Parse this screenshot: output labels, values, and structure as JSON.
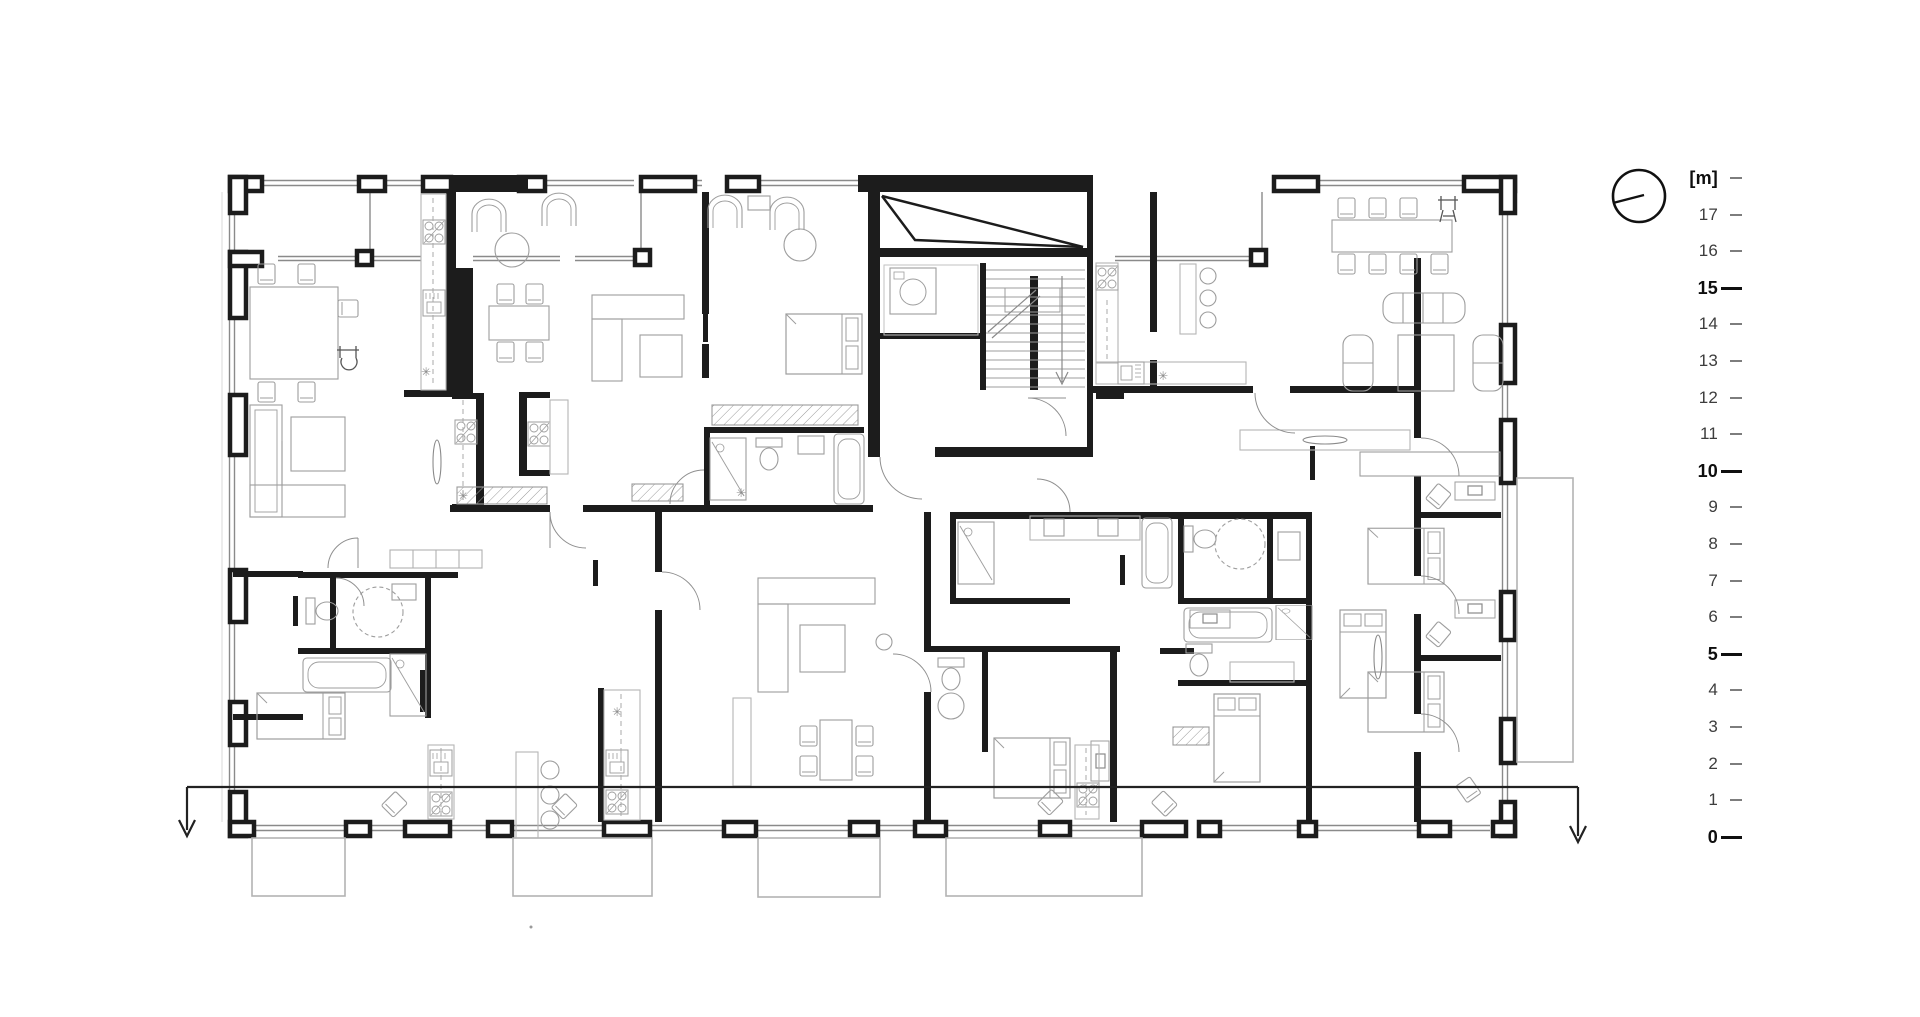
{
  "drawing": {
    "kind": "floor-plan"
  },
  "colors": {
    "background": "#ffffff",
    "wall": "#1c1c1c",
    "window_line": "#8a8a8a",
    "furniture_line": "#9d9d9d",
    "balcony_line": "#b3b3b3",
    "section_line": "#222222",
    "tick_minor": "#7d7d7d",
    "tick_major": "#101010",
    "label_minor": "#3d3d3d",
    "label_major": "#0e0e0e"
  },
  "scale_bar": {
    "unit_label": "[m]",
    "ticks": [
      {
        "label": "[m]",
        "major": false
      },
      {
        "label": "17",
        "major": false
      },
      {
        "label": "16",
        "major": false
      },
      {
        "label": "15",
        "major": true
      },
      {
        "label": "14",
        "major": false
      },
      {
        "label": "13",
        "major": false
      },
      {
        "label": "12",
        "major": false
      },
      {
        "label": "11",
        "major": false
      },
      {
        "label": "10",
        "major": true
      },
      {
        "label": "9",
        "major": false
      },
      {
        "label": "8",
        "major": false
      },
      {
        "label": "7",
        "major": false
      },
      {
        "label": "6",
        "major": false
      },
      {
        "label": "5",
        "major": true
      },
      {
        "label": "4",
        "major": false
      },
      {
        "label": "3",
        "major": false
      },
      {
        "label": "2",
        "major": false
      },
      {
        "label": "1",
        "major": false
      },
      {
        "label": "0",
        "major": true
      }
    ]
  }
}
